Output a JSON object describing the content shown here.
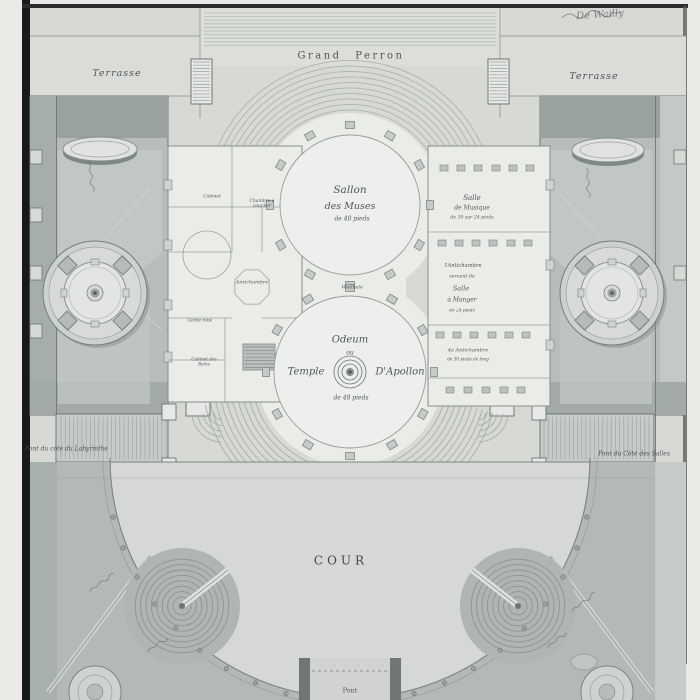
{
  "artwork": {
    "signature": "De Wailly"
  },
  "palette": {
    "paper": "#d7d9d5",
    "garden_wash": "#b6bdba",
    "dark_wash": "#99a29f",
    "building": "#eaece8",
    "court": "#d5d8d4",
    "ink": "#3b4145"
  },
  "plan": {
    "terraces": {
      "left": "Terrasse",
      "right": "Terrasse"
    },
    "grand_perron": "Grand Perron",
    "salon": {
      "l1": "Sallon",
      "l2": "des Muses",
      "l3": "de 40 pieds"
    },
    "salle_musique": {
      "l1": "Salle",
      "l2": "de Musique",
      "l3": "de 30 sur 24 pieds"
    },
    "salle_manger": {
      "l1": "l'Antichambre",
      "l2": "servant de",
      "l3": "Salle",
      "l4": "à Manger",
      "l5": "de 24 pieds"
    },
    "antichambre4": {
      "l1": "4e Antichambre",
      "l2": "de 30 pieds de long"
    },
    "left_wing": {
      "cabinet": "Cabinet",
      "chambre": "Chambre à coucher",
      "antichambre": "Antichambre",
      "garde_robe": "Garde robe",
      "bains": "Cabinet des Bains",
      "vestibule": "Vestibule"
    },
    "odeum": {
      "l1": "Odeum",
      "l2": "ou",
      "l3a": "Temple",
      "l3b": "D'Apollon",
      "l4": "de 48 pieds"
    },
    "bridges": {
      "left": "Pont du côté du Labyrinthe",
      "right": "Pont du Côté des Salles",
      "bottom": "Pont"
    },
    "court": "COUR"
  }
}
